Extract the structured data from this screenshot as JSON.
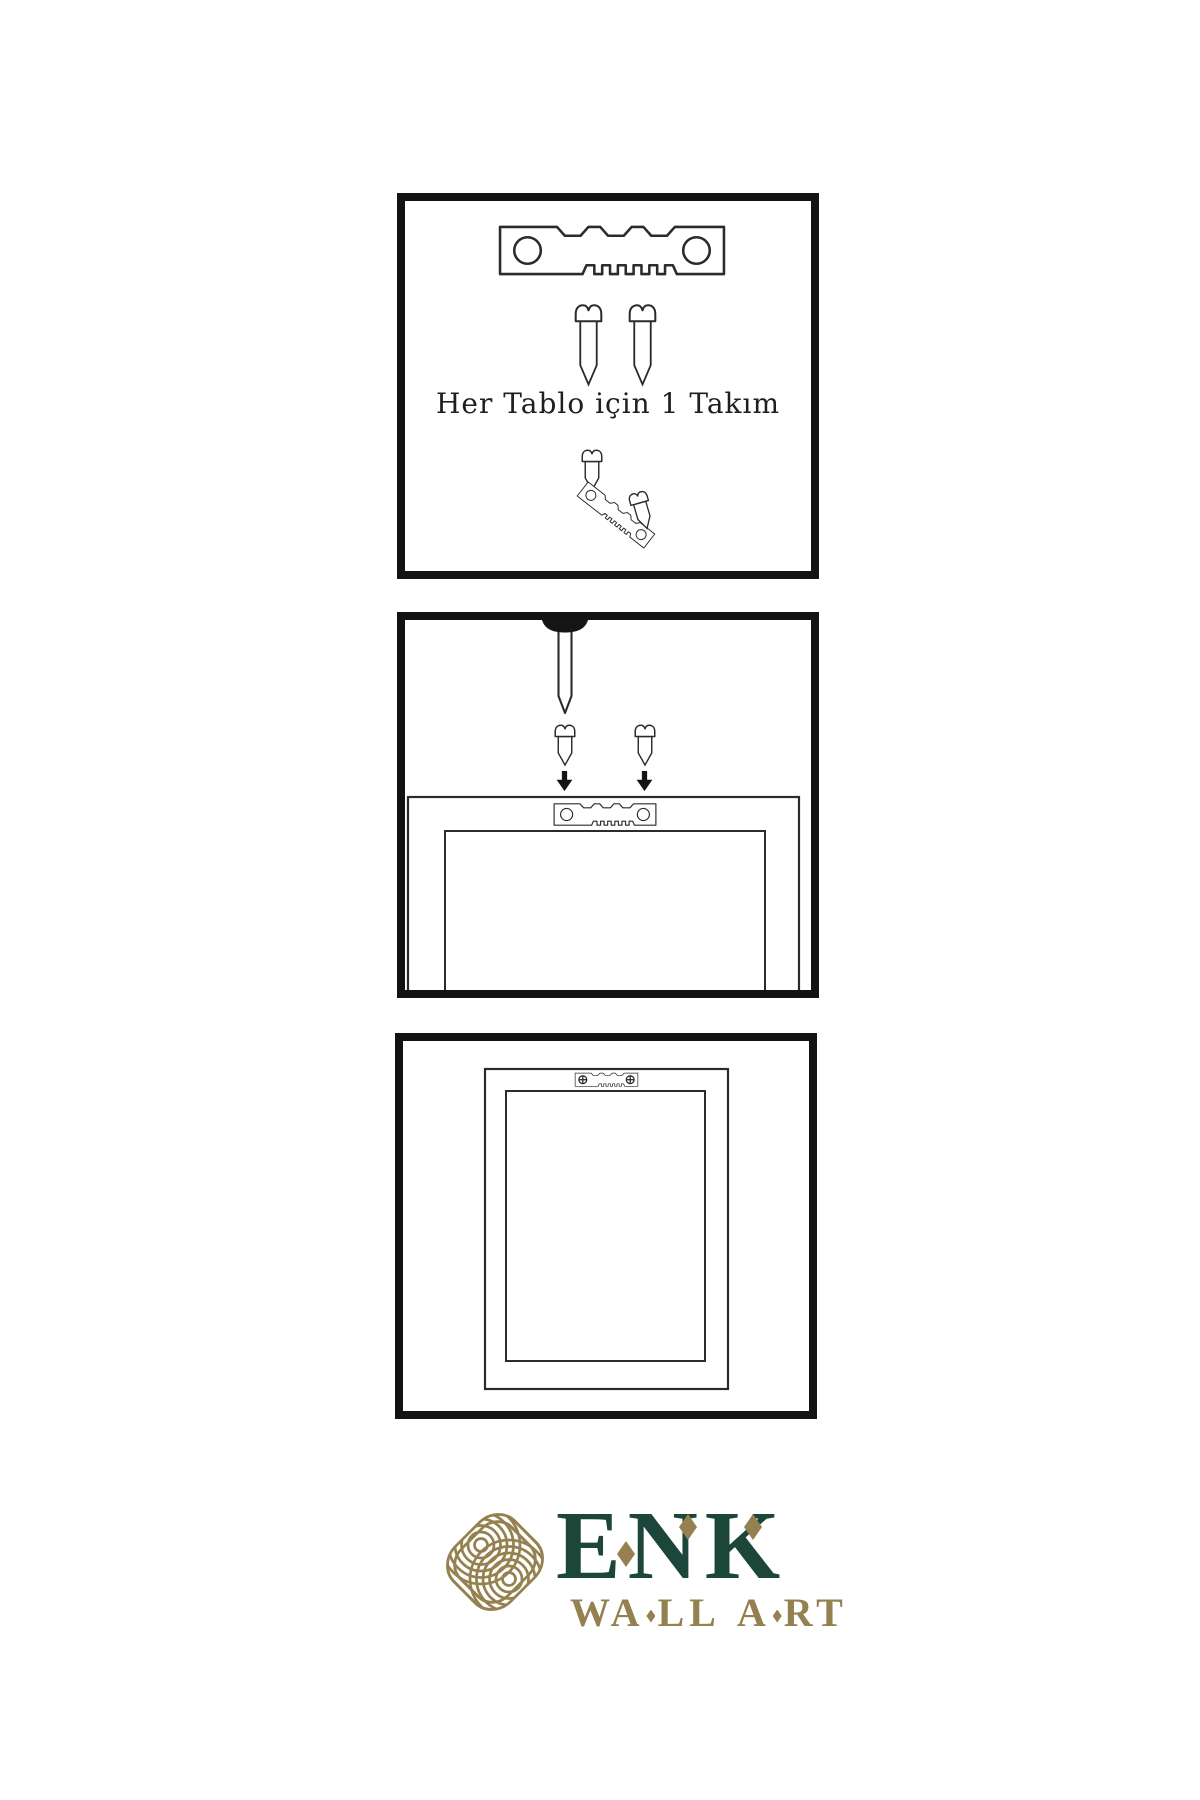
{
  "page": {
    "background": "#ffffff",
    "language": "tr"
  },
  "colors": {
    "panel-border": "#131313",
    "line": "#2b2b2b",
    "ink": "#1f1f1f",
    "dark": "#3b3b3b",
    "stripe": "#9a9a9a",
    "thread": "#555555",
    "gold": "#95814f",
    "green": "#1b4639"
  },
  "instructions": {
    "step1": {
      "caption": "Her Tablo için 1 Takım",
      "icons": [
        "sawtooth-hanger-icon",
        "screw-icon",
        "screw-icon",
        "screw-into-hanger-icon"
      ]
    },
    "step2": {
      "icons": [
        "wall-nail-icon",
        "screw-icon",
        "screw-icon",
        "down-arrow-icon",
        "down-arrow-icon",
        "frame-back-icon",
        "sawtooth-hanger-icon"
      ]
    },
    "step3": {
      "icons": [
        "frame-back-icon",
        "sawtooth-hanger-mounted-icon"
      ]
    }
  },
  "logo": {
    "brand": "ENK",
    "tagline_parts": [
      "WA",
      "LL",
      "A",
      "RT"
    ],
    "mark": "interlocking-knot-icon"
  }
}
